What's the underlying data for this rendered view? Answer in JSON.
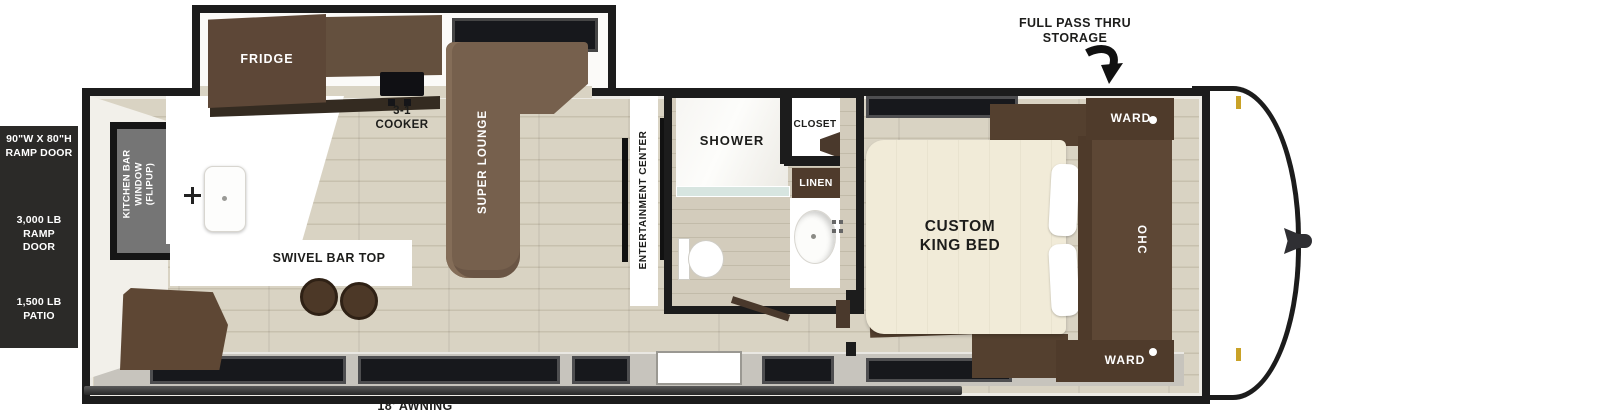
{
  "specs_panel": {
    "ramp_door_size": "90\"W X 80\"H\nRAMP DOOR",
    "ramp_capacity": "3,000 LB RAMP\nDOOR",
    "patio_capacity": "1,500 LB\nPATIO"
  },
  "exterior": {
    "storage_label": "FULL PASS THRU\nSTORAGE",
    "awning_label": "18' AWNING"
  },
  "kitchen": {
    "fridge_label": "FRIDGE",
    "cooker_label": "3-1\nCOOKER",
    "window_label": "KITCHEN BAR\nWINDOW\n(FLIPUP)",
    "bar_label": "SWIVEL BAR TOP",
    "lounge_label": "SUPER LOUNGE"
  },
  "living": {
    "entertainment_label": "ENTERTAINMENT CENTER"
  },
  "bathroom": {
    "shower_label": "SHOWER",
    "closet_label": "CLOSET",
    "linen_label": "LINEN"
  },
  "bedroom": {
    "bed_label": "CUSTOM\nKING BED",
    "ohc_label": "OHC",
    "ward_top_label": "WARD",
    "ward_bottom_label": "WARD"
  },
  "colors": {
    "wall": "#1c1c1c",
    "floor": "#d9d3c3",
    "wood_dark": "#54402f",
    "wood_mid": "#76604d",
    "bed_cream": "#f1ebd8",
    "latch_gold": "#c9a227",
    "panel_black": "#2b2a28"
  }
}
